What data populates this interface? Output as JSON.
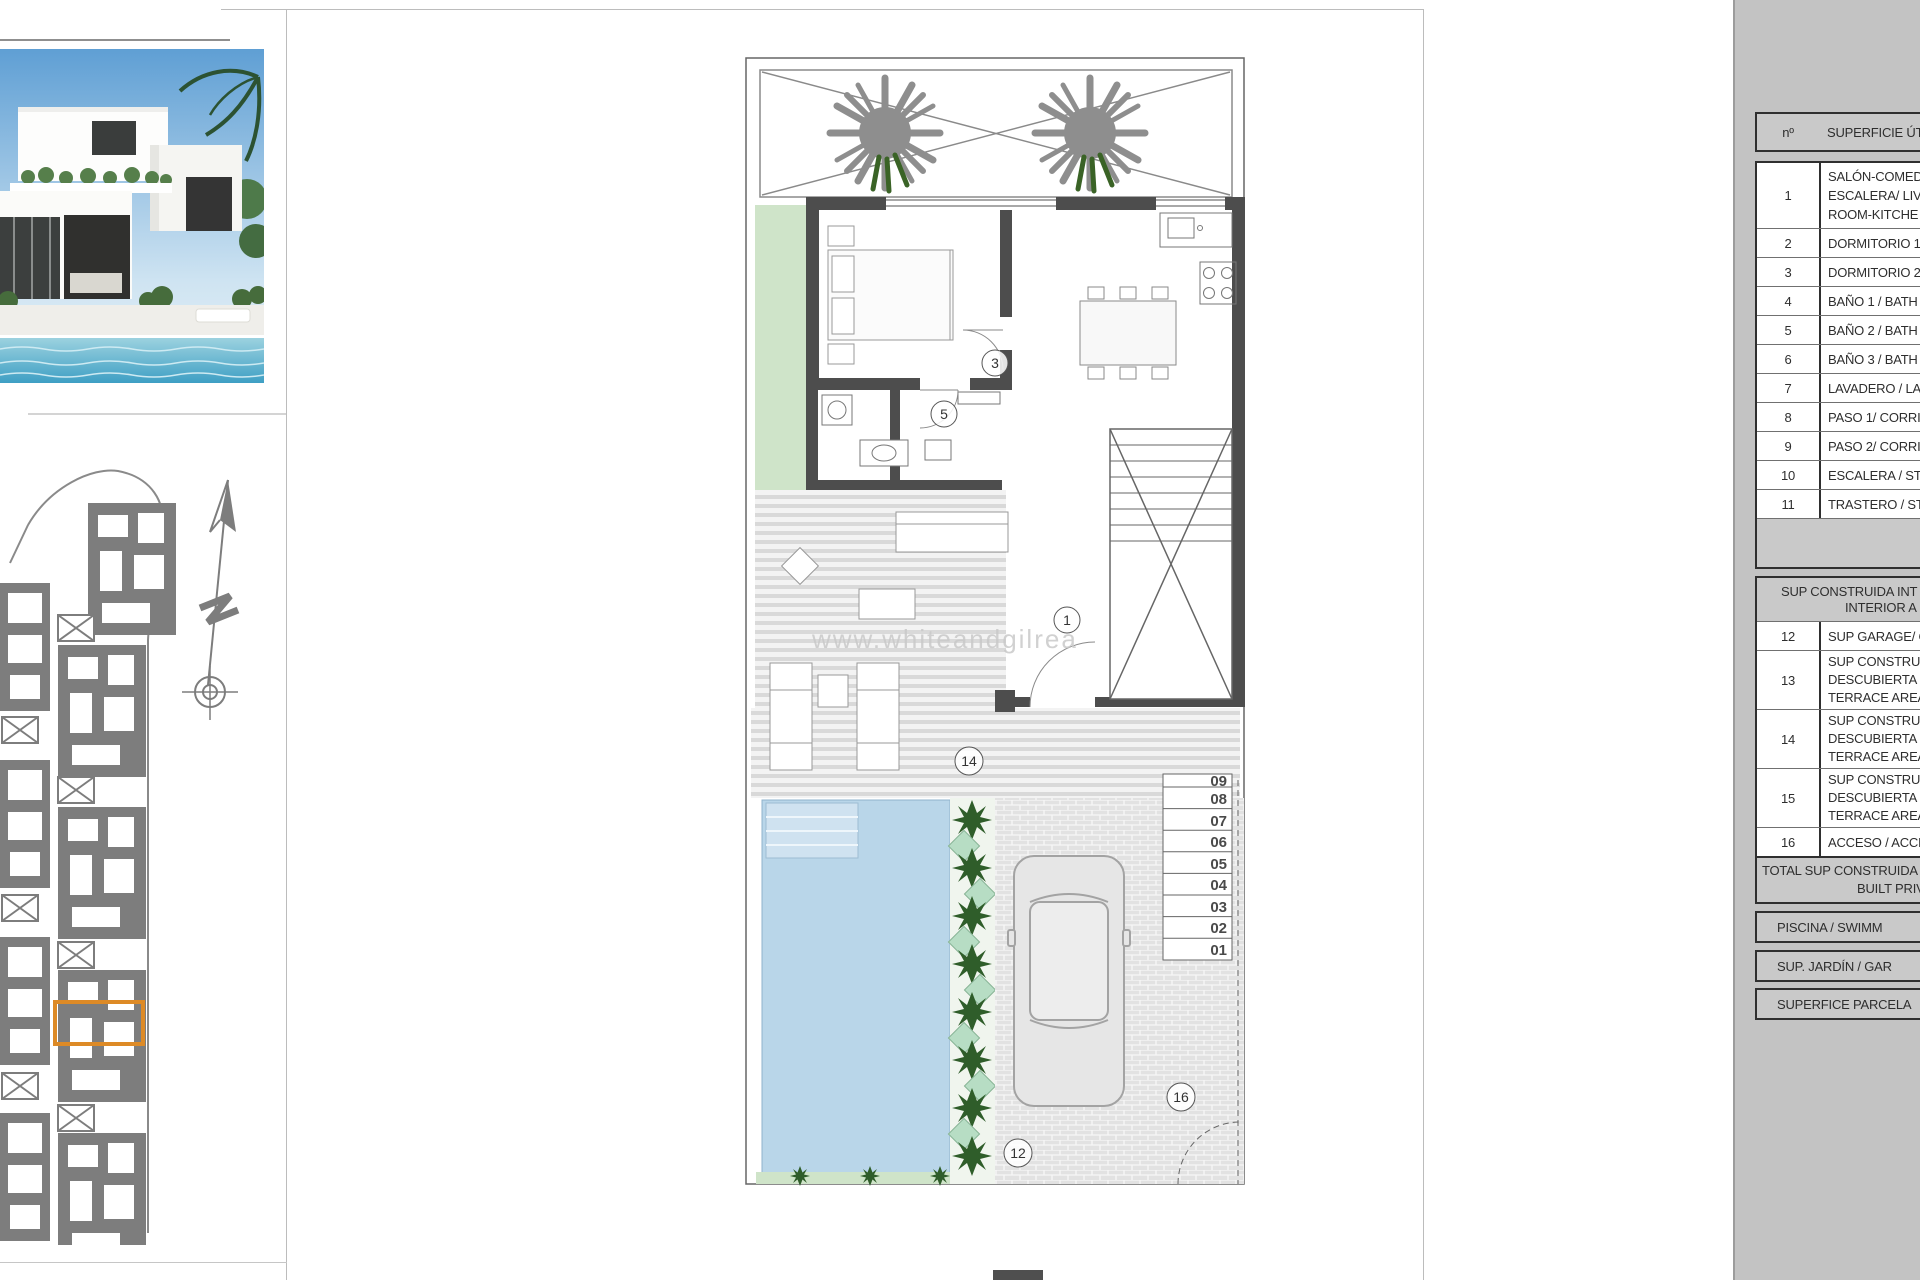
{
  "sheet": {
    "watermark": "www.whiteandgilrea"
  },
  "plan": {
    "callouts": {
      "living": "1",
      "bedroom_door": "3",
      "bath_door": "5",
      "garage": "12",
      "terrace": "14",
      "access": "16"
    },
    "steps": [
      "09",
      "08",
      "07",
      "06",
      "05",
      "04",
      "03",
      "02",
      "01"
    ]
  },
  "table": {
    "header": {
      "col_num": "nº",
      "col_label": "SUPERFICIE ÚTI"
    },
    "rows_util": [
      {
        "num": "1",
        "lines": [
          "SALÓN-COMED",
          "ESCALERA/ LIVI",
          "ROOM-KITCHE"
        ]
      },
      {
        "num": "2",
        "lines": [
          "DORMITORIO 1"
        ]
      },
      {
        "num": "3",
        "lines": [
          "DORMITORIO 2"
        ]
      },
      {
        "num": "4",
        "lines": [
          "BAÑO 1 / BATH"
        ]
      },
      {
        "num": "5",
        "lines": [
          "BAÑO 2 / BATH"
        ]
      },
      {
        "num": "6",
        "lines": [
          "BAÑO 3 / BATH"
        ]
      },
      {
        "num": "7",
        "lines": [
          "LAVADERO / LA"
        ]
      },
      {
        "num": "8",
        "lines": [
          "PASO 1/ CORRI"
        ]
      },
      {
        "num": "9",
        "lines": [
          "PASO 2/ CORRI"
        ]
      },
      {
        "num": "10",
        "lines": [
          "ESCALERA / STA"
        ]
      },
      {
        "num": "11",
        "lines": [
          "TRASTERO / STO"
        ]
      }
    ],
    "section2_header": {
      "lines": [
        "SUP CONSTRUIDA INT",
        "INTERIOR A"
      ]
    },
    "rows_built": [
      {
        "num": "12",
        "lines": [
          "SUP GARAGE/ C"
        ]
      },
      {
        "num": "13",
        "lines": [
          "SUP CONSTRUI",
          "DESCUBIERTA 1",
          "TERRACE AREA"
        ]
      },
      {
        "num": "14",
        "lines": [
          "SUP CONSTRUI",
          "DESCUBIERTA 2",
          "TERRACE AREA"
        ]
      },
      {
        "num": "15",
        "lines": [
          "SUP CONSTRUI",
          "DESCUBIERTA 3",
          "TERRACE AREA"
        ]
      },
      {
        "num": "16",
        "lines": [
          "ACCESO / ACCE"
        ]
      }
    ],
    "total": {
      "lines": [
        "TOTAL SUP CONSTRUIDA",
        "BUILT PRIVAT"
      ]
    },
    "bands": [
      "PISCINA / SWIMM",
      "SUP. JARDÍN / GAR",
      "SUPERFICE PARCELA"
    ]
  }
}
